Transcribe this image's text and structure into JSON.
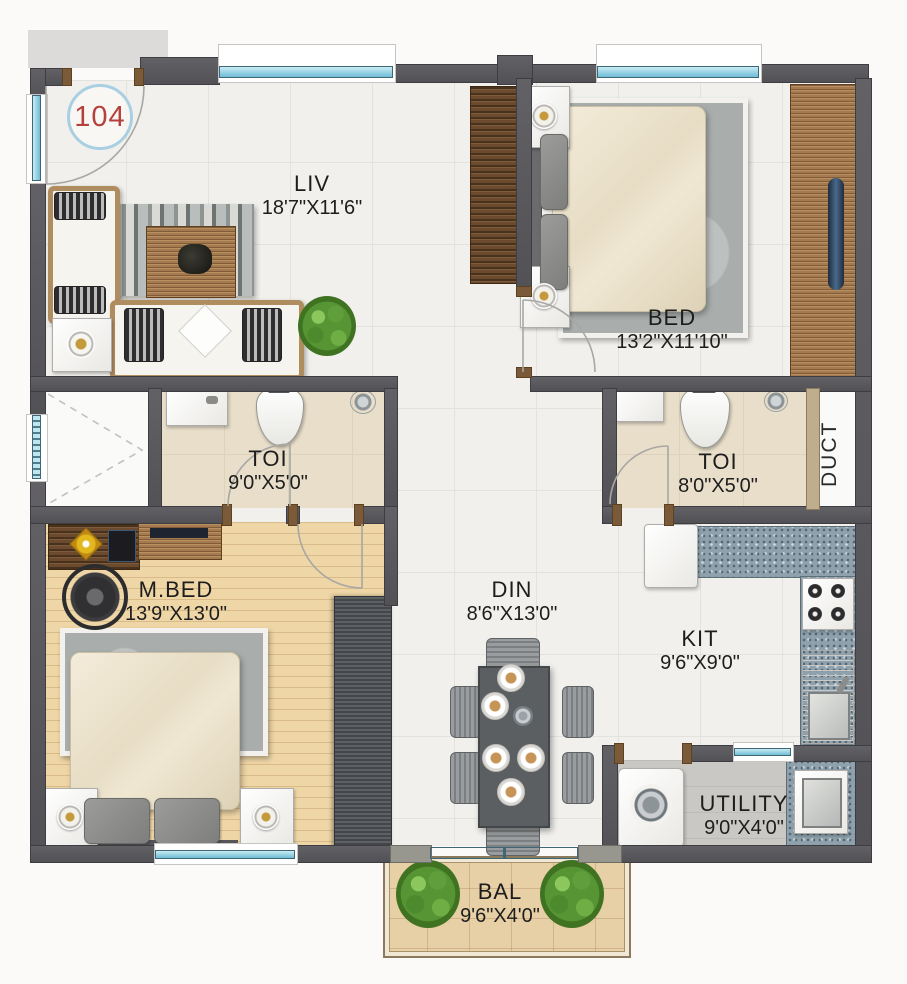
{
  "unit": {
    "number": "104"
  },
  "rooms": {
    "liv": {
      "name": "LIV",
      "dims": "18'7\"X11'6\""
    },
    "bed": {
      "name": "BED",
      "dims": "13'2\"X11'10\""
    },
    "toi1": {
      "name": "TOI",
      "dims": "9'0\"X5'0\""
    },
    "toi2": {
      "name": "TOI",
      "dims": "8'0\"X5'0\""
    },
    "duct": {
      "name": "DUCT"
    },
    "mbed": {
      "name": "M.BED",
      "dims": "13'9\"X13'0\""
    },
    "din": {
      "name": "DIN",
      "dims": "8'6\"X13'0\""
    },
    "kit": {
      "name": "KIT",
      "dims": "9'6\"X9'0\""
    },
    "utility": {
      "name": "UTILITY",
      "dims": "9'0\"X4'0\""
    },
    "bal": {
      "name": "BAL",
      "dims": "9'6\"X4'0\""
    }
  },
  "colors": {
    "unit_number": "#b5413d",
    "unit_circle": "#a9cfe2",
    "wall": "#58585b",
    "window_glass": "#7ac4dc",
    "wood_floor": "#ecd4a4",
    "granite_counter": "#8ea1ac",
    "plant_green": "#579433",
    "label_text": "#1d1d1d"
  }
}
